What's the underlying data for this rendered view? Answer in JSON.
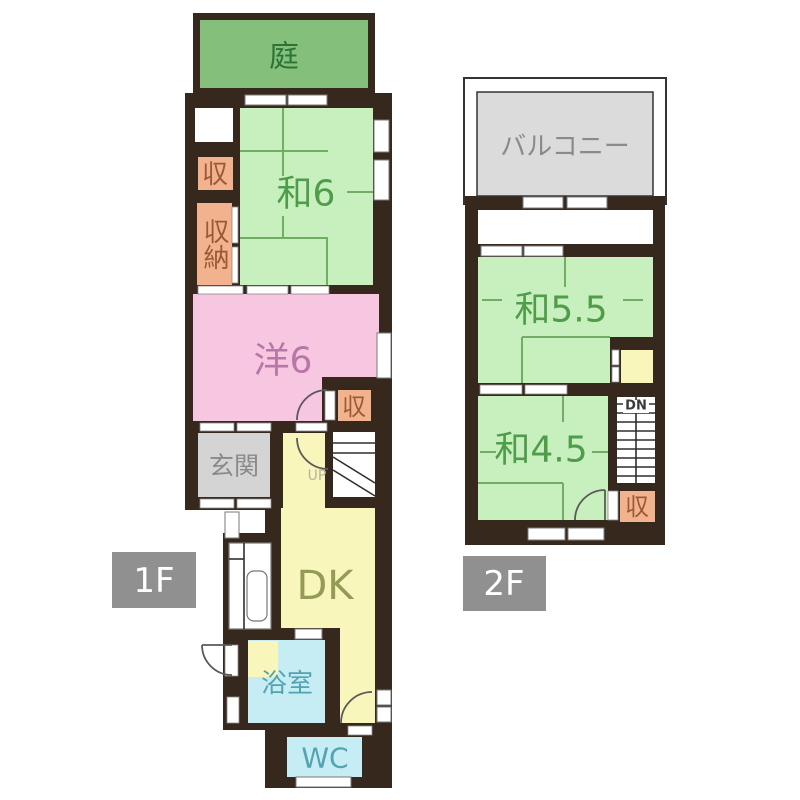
{
  "colors": {
    "wall": "#37281e",
    "tatami_green": "#c8efbe",
    "tatami_line": "#6fae63",
    "room_text_green": "#4f9c4b",
    "garden_green": "#84c07b",
    "garden_text": "#2c7436",
    "closet_orange": "#f2b28d",
    "closet_text": "#9b5a35",
    "pink": "#f7c6e1",
    "pink_text": "#b777a7",
    "gray_room": "#d4d4d4",
    "gray_text": "#8a8a8a",
    "yellow": "#f9f6bb",
    "dk_text": "#949b56",
    "cyan": "#c5edf3",
    "cyan_text": "#54a3b2",
    "balcony_gray": "#dbdbdb",
    "label_bg": "#909090",
    "label_text": "#ffffff",
    "stair_up_text": "#b3b39e",
    "stair_dn_text": "#3a3a3a",
    "white": "#ffffff"
  },
  "floor1": {
    "label": "1F",
    "rooms": {
      "garden": "庭",
      "washitsu6": "和6",
      "closet_a": "収",
      "closet_b": "収納",
      "western6": "洋6",
      "closet_c": "収",
      "entrance": "玄関",
      "stairs_up": "UP",
      "dining_kitchen": "DK",
      "bathroom": "浴室",
      "toilet": "WC"
    }
  },
  "floor2": {
    "label": "2F",
    "rooms": {
      "balcony": "バルコニー",
      "washitsu55": "和5.5",
      "washitsu45": "和4.5",
      "stairs_down": "DN",
      "closet_d": "収"
    }
  }
}
